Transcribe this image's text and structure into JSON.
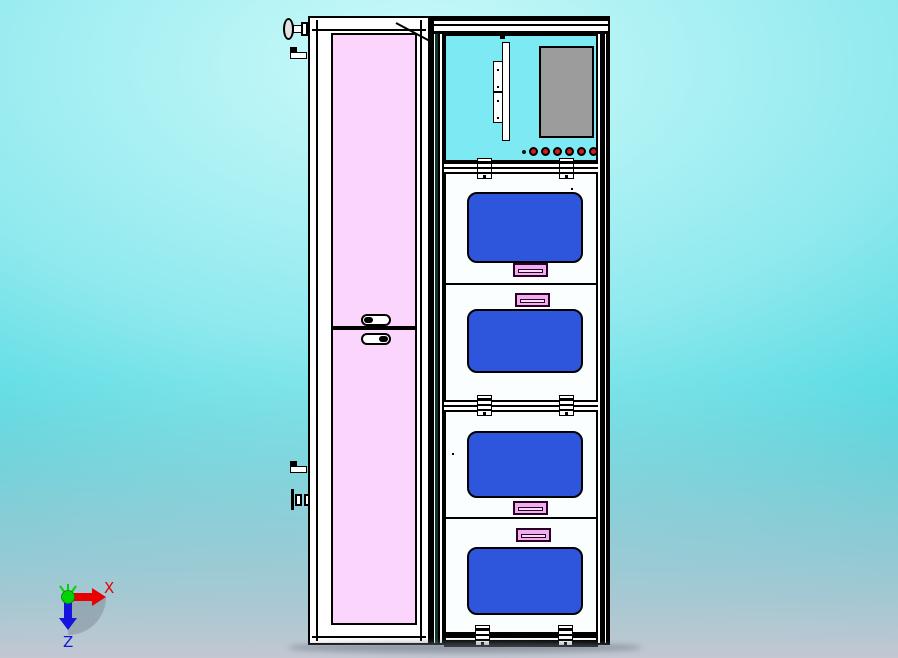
{
  "triad": {
    "x_label": "X",
    "z_label": "Z"
  },
  "machine": {
    "left_cabinet": {
      "doors": [
        {
          "id": "upper-pink-door",
          "handle": "pill-bottom"
        },
        {
          "id": "lower-pink-door",
          "handle": "pill-top"
        }
      ]
    },
    "right_cabinet": {
      "hmi_section": {
        "has_monitor": true,
        "has_mounting_bracket": true,
        "red_buttons": 6
      },
      "doors": [
        {
          "id": "door-1",
          "window": "blue",
          "handle_position": "bottom"
        },
        {
          "id": "door-2",
          "window": "blue",
          "handle_position": "top"
        },
        {
          "id": "door-3",
          "window": "blue",
          "handle_position": "bottom"
        },
        {
          "id": "door-4",
          "window": "blue",
          "handle_position": "top"
        }
      ],
      "hinge_pairs": 3
    }
  },
  "colors": {
    "bg-edge": "#00c6cf",
    "bg-mid": "#8fe9ee",
    "bg-light": "#cdfafa",
    "bg-floor": "#c3c7d2",
    "outline": "#000000",
    "frame-white": "#ffffff",
    "panel-white": "#fbfeff",
    "door-pink": "#fcd5fc",
    "hmi-cyan": "#7de9f2",
    "monitor-gray": "#9c9c9c",
    "window-blue": "#2e56dd",
    "handle-pink": "#f0aeee",
    "handle-pink-light": "#fbd9fa",
    "handle-dark": "#2a0026",
    "button-red": "#cc2020",
    "axis-x": "#e80000",
    "axis-z": "#1414dd",
    "axis-origin": "#00d400",
    "shadow-gray": "#6e7681"
  }
}
